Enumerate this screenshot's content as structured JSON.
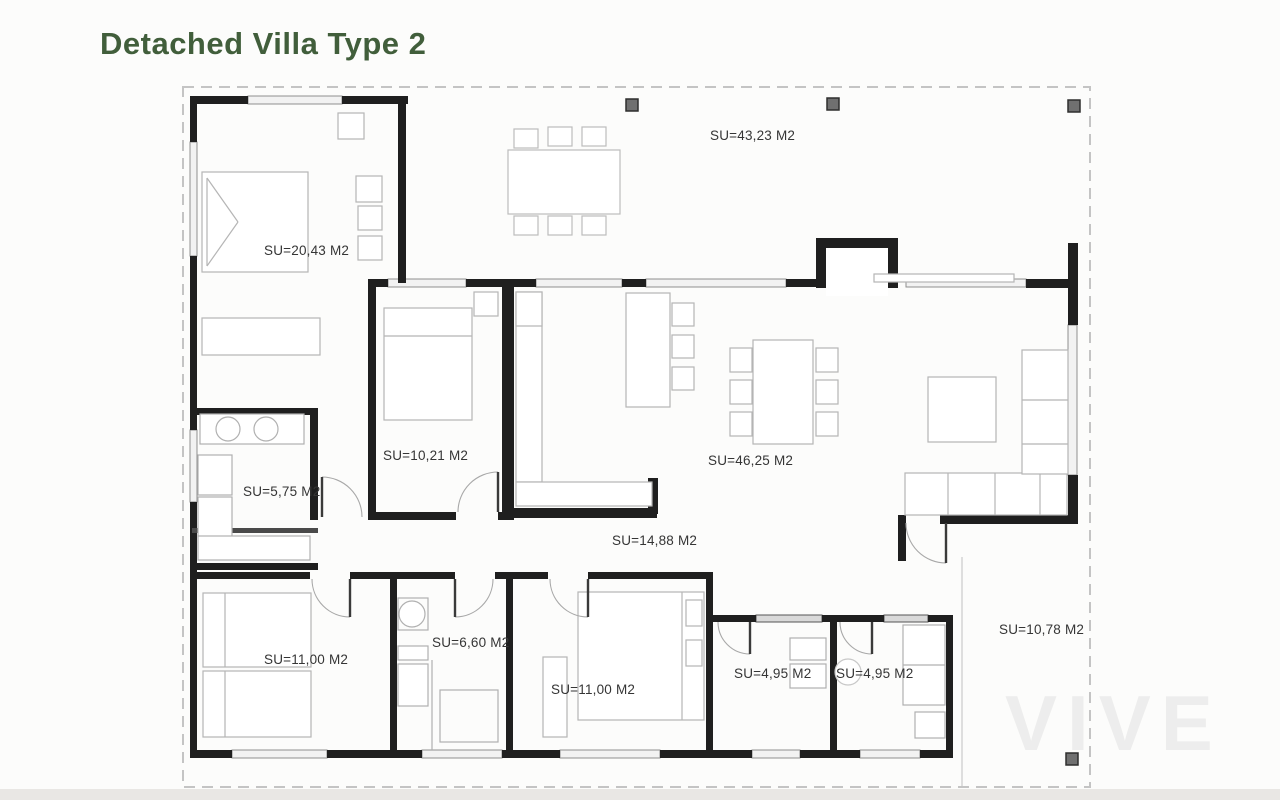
{
  "page": {
    "title": "Detached Villa Type 2"
  },
  "plan": {
    "watermark": "VIVE",
    "area_unit": "M2",
    "rooms": [
      {
        "id": "master-bedroom",
        "label": "SU=20,43 M2"
      },
      {
        "id": "front-porch",
        "label": "SU=43,23 M2"
      },
      {
        "id": "bedroom-2",
        "label": "SU=10,21 M2"
      },
      {
        "id": "bathroom-1",
        "label": "SU=5,75 M2"
      },
      {
        "id": "living-dining-kitchen",
        "label": "SU=46,25 M2"
      },
      {
        "id": "hallway",
        "label": "SU=14,88 M2"
      },
      {
        "id": "bedroom-3",
        "label": "SU=11,00 M2"
      },
      {
        "id": "bathroom-2",
        "label": "SU=6,60 M2"
      },
      {
        "id": "bedroom-4",
        "label": "SU=11,00 M2"
      },
      {
        "id": "bathroom-3",
        "label": "SU=4,95 M2"
      },
      {
        "id": "bathroom-4",
        "label": "SU=4,95 M2"
      },
      {
        "id": "side-porch",
        "label": "SU=10,78 M2"
      }
    ],
    "colors": {
      "title": "#415e3b",
      "walls": "#1f1f1f",
      "furniture": "#b5b5b5",
      "boundary": "#c4c4c4",
      "pillar": "#707070"
    }
  }
}
